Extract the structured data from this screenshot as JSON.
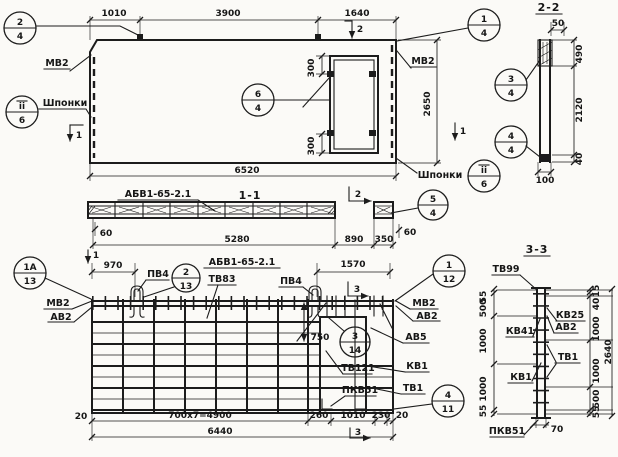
{
  "panel": {
    "mark": "АБВ1-65-2.1",
    "dim_1010": "1010",
    "dim_3900": "3900",
    "dim_1640": "1640",
    "dim_6520": "6520",
    "dim_2650": "2650",
    "dim_300_top": "300",
    "dim_300_bot": "300",
    "label_mv2_left": "МВ2",
    "label_mv2_right": "МВ2",
    "label_shponki_left": "Шпонки",
    "label_shponki_right": "Шпонки",
    "cut1_left": "1",
    "cut1_right": "1",
    "cut2_top": "2"
  },
  "section11": {
    "title": "1-1",
    "cut2": "2",
    "dim_60_left": "60",
    "dim_5280": "5280",
    "dim_890": "890",
    "dim_350": "350",
    "dim_60_right": "60"
  },
  "section22": {
    "title": "2-2",
    "dim_50": "50",
    "dim_490": "490",
    "dim_2120": "2120",
    "dim_40": "40",
    "dim_100": "100"
  },
  "plan": {
    "mark": "АБВ1-65-2.1",
    "cut1_top": "1",
    "cut3_top": "3",
    "cut3_bottom": "3",
    "dim_970": "970",
    "dim_1570": "1570",
    "dim_750": "750",
    "dim_20_left": "20",
    "dim_4900": "700x7=4900",
    "dim_260": "260",
    "dim_1010": "1010",
    "dim_230": "230",
    "dim_20_right": "20",
    "dim_6440": "6440",
    "labels": {
      "pv4_1": "ПВ4",
      "pv4_2": "ПВ4",
      "tv83": "ТВ83",
      "mv2_left": "МВ2",
      "av2_left": "АВ2",
      "mv2_right": "МВ2",
      "av2_right": "АВ2",
      "av5": "АВ5",
      "tv121": "ТВ121",
      "kv1": "КВ1",
      "pkv51": "ПКВ51",
      "tv1": "ТВ1"
    }
  },
  "section33": {
    "title": "3-3",
    "dim_total": "2640",
    "dim_70": "70",
    "left_dims": [
      "55",
      "500",
      "1000",
      "1000",
      "55"
    ],
    "right_dims": [
      "15",
      "40",
      "1000",
      "1000",
      "500",
      "55"
    ],
    "labels": {
      "tv99": "ТВ99",
      "kv25": "КВ25",
      "av2": "АВ2",
      "kv41": "КВ41",
      "tv1": "ТВ1",
      "kv1": "КВ1",
      "pkv51": "ПКВ51"
    }
  },
  "callouts": [
    {
      "top": "2",
      "bottom": "4"
    },
    {
      "top": "ii",
      "bottom": "6"
    },
    {
      "top": "1",
      "bottom": "4"
    },
    {
      "top": "6",
      "bottom": "4"
    },
    {
      "top": "ii",
      "bottom": "6"
    },
    {
      "top": "5",
      "bottom": "4"
    },
    {
      "top": "3",
      "bottom": "4"
    },
    {
      "top": "4",
      "bottom": "4"
    },
    {
      "top": "1А",
      "bottom": "13"
    },
    {
      "top": "2",
      "bottom": "13"
    },
    {
      "top": "1",
      "bottom": "12"
    },
    {
      "top": "3",
      "bottom": "14"
    },
    {
      "top": "4",
      "bottom": "11"
    }
  ]
}
